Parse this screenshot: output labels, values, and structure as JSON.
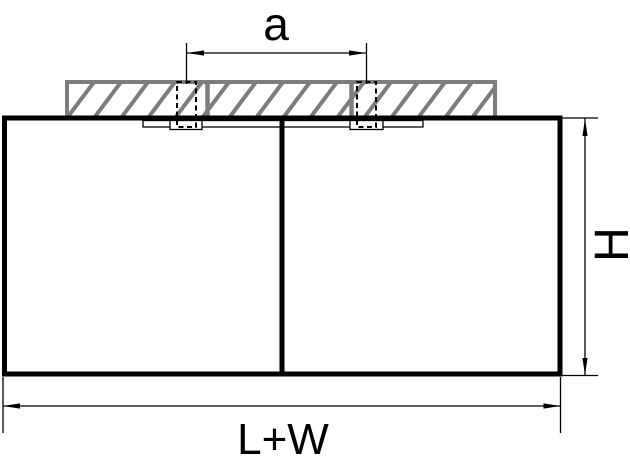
{
  "diagram": {
    "type": "technical-dimension-drawing",
    "subject": "surface-mounted double light fixture, front elevation with ceiling section",
    "labels": {
      "spacing": "a",
      "height": "H",
      "width": "L+W"
    },
    "colors": {
      "line": "#000000",
      "hatch": "#7d7d7d",
      "background": "#ffffff"
    }
  }
}
